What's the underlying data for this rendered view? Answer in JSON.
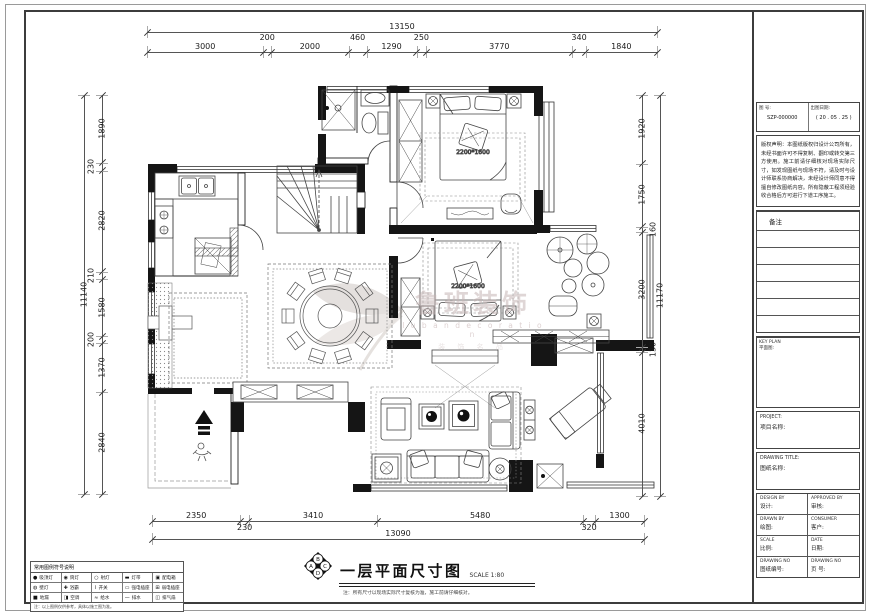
{
  "sheet": {
    "title": "一层平面尺寸图",
    "scale_text": "SCALE 1:80",
    "note": "注：所有尺寸以现场实际尺寸复核为准，施工前请仔细核对。",
    "marker_letters": [
      "B",
      "A",
      "C",
      "D"
    ]
  },
  "watermark": {
    "brand": "鲁班装饰",
    "brand_sub": "l u b a n   d e c o r a t i o n",
    "brand_tag": "装 饰 名 品"
  },
  "plan_labels": {
    "bed1_size": "2200*1600",
    "bed2_size": "2200*1600"
  },
  "dimensions": {
    "top": {
      "total": 13150,
      "segments": [
        3000,
        200,
        2000,
        460,
        1290,
        250,
        3770,
        340,
        1840
      ]
    },
    "bottom": {
      "total": 13090,
      "segments": [
        2350,
        230,
        3410,
        5480,
        320,
        1300
      ]
    },
    "left": {
      "total": 11140,
      "segments": [
        1890,
        230,
        2820,
        210,
        1580,
        200,
        1370,
        2840
      ]
    },
    "right": {
      "total": 11170,
      "segments": [
        1920,
        1750,
        160,
        3200,
        130,
        4010
      ]
    }
  },
  "titleblock": {
    "doc_no_label": "图 号:",
    "doc_no": "SZP-000000",
    "date_label": "出图日期:",
    "date": "( 20 . 05 . 25 )",
    "notice": "版权声明：本图纸版权归设计公司所有，未经书面许可不得复制、翻印或转交第三方使用。施工前请仔细核对现场实际尺寸，如发现图纸与现场不符，请及时与设计师联系协商解决，未经设计师同意不得擅自修改图纸内容。所有隐蔽工程须经验收合格后方可进行下道工序施工。",
    "remark_label": "备注",
    "keyplan_label": "KEY PLAN",
    "keyplan_cn": "平面图:",
    "project_label": "PROJECT:",
    "project_cn": "项目名称:",
    "title_label": "DRAWING TITLE:",
    "title_cn": "图纸名称:",
    "grid": [
      {
        "en": "DESIGN BY",
        "cn": "设计:"
      },
      {
        "en": "APPROVED BY",
        "cn": "审核:"
      },
      {
        "en": "DRAWN BY",
        "cn": "绘图:"
      },
      {
        "en": "CONSUMER",
        "cn": "客户:"
      },
      {
        "en": "SCALE",
        "cn": "比例:"
      },
      {
        "en": "DATE",
        "cn": "日期:"
      },
      {
        "en": "DRAWING NO",
        "cn": "图纸编号:"
      },
      {
        "en": "DRAWING NO",
        "cn": "页 号:"
      }
    ]
  },
  "legend": {
    "header": "常用图例符号说明",
    "rows": [
      [
        [
          "●",
          "吸顶灯"
        ],
        [
          "◉",
          "筒灯"
        ],
        [
          "○",
          "射灯"
        ],
        [
          "▬",
          "灯带"
        ],
        [
          "▣",
          "配电箱"
        ]
      ],
      [
        [
          "◍",
          "壁灯"
        ],
        [
          "✚",
          "浴霸"
        ],
        [
          "⌇",
          "开关"
        ],
        [
          "▭",
          "强电插座"
        ],
        [
          "⊞",
          "弱电插座"
        ]
      ],
      [
        [
          "■",
          "地漏"
        ],
        [
          "◨",
          "空调"
        ],
        [
          "≈",
          "给水"
        ],
        [
          "—",
          "排水"
        ],
        [
          "◫",
          "排气扇"
        ]
      ]
    ],
    "caption": "注：以上图例仅供参考，具体以施工图为准。"
  }
}
